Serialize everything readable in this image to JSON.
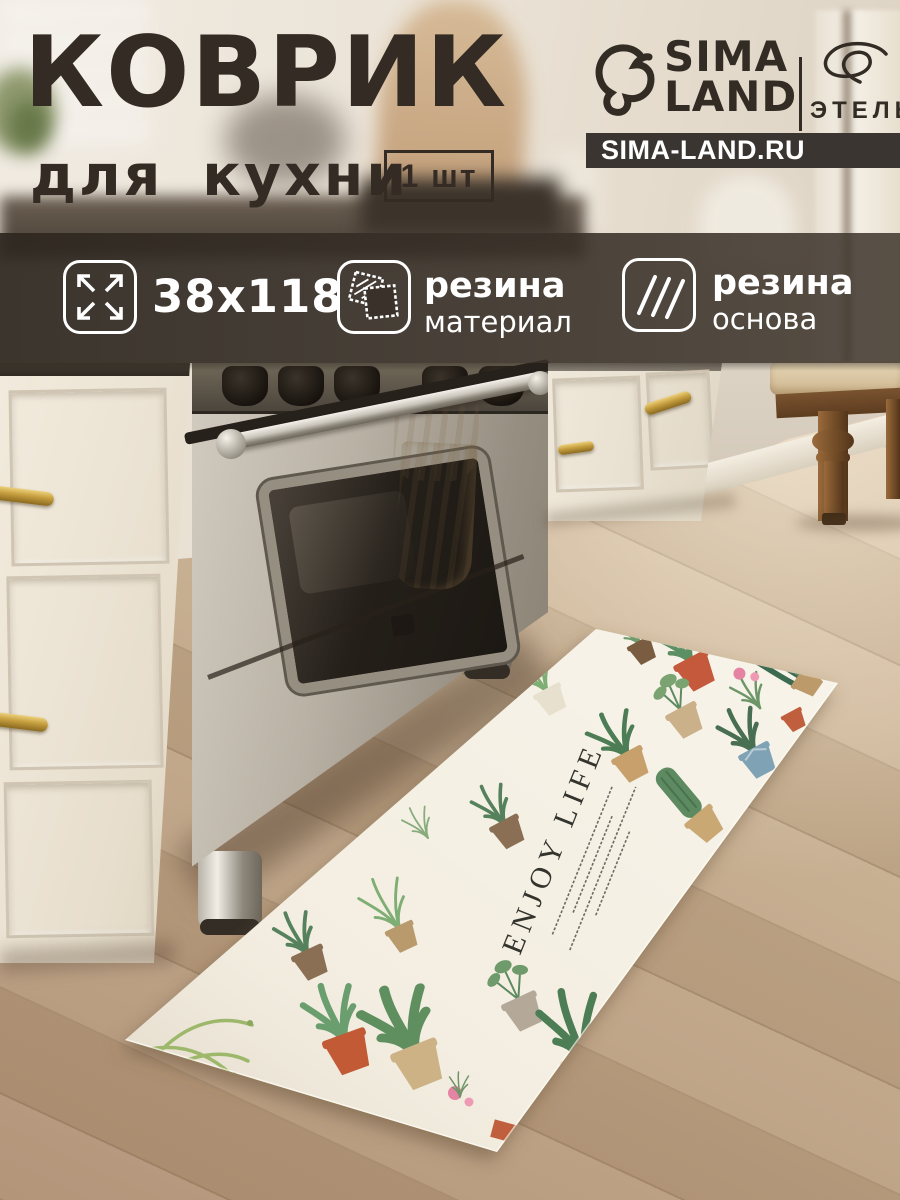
{
  "header": {
    "title_line1": "КОВРИК",
    "title_line2": "для кухни",
    "quantity_badge": "1 шт"
  },
  "brand": {
    "logo_icon": "dolphin-logo-icon",
    "logo_line1": "SIMA",
    "logo_line2": "LAND",
    "sub_brand_icon": "script-signature-icon",
    "sub_brand": "ЭТЕЛЬ",
    "website": "SIMA-LAND.RU"
  },
  "features": [
    {
      "icon": "expand-arrows-icon",
      "value": "38x118"
    },
    {
      "icon": "fabric-swatch-icon",
      "title": "резина",
      "subtitle": "материал"
    },
    {
      "icon": "hatch-lines-icon",
      "title": "резина",
      "subtitle": "основа"
    }
  ],
  "mat": {
    "slogan": "ENJOY LIFE"
  },
  "colors": {
    "title_text": "#342c24",
    "banner_overlay": "rgba(52,45,38,0.9)",
    "website_bar_bg": "#3a3531",
    "feature_text": "#ffffff",
    "mat_base": "#f4efe2",
    "pot_terracotta": "#c4593b",
    "leaf_green": "#5c8f63",
    "brass_handle": "#c9a23f",
    "floor_wood": "#c3a788"
  }
}
